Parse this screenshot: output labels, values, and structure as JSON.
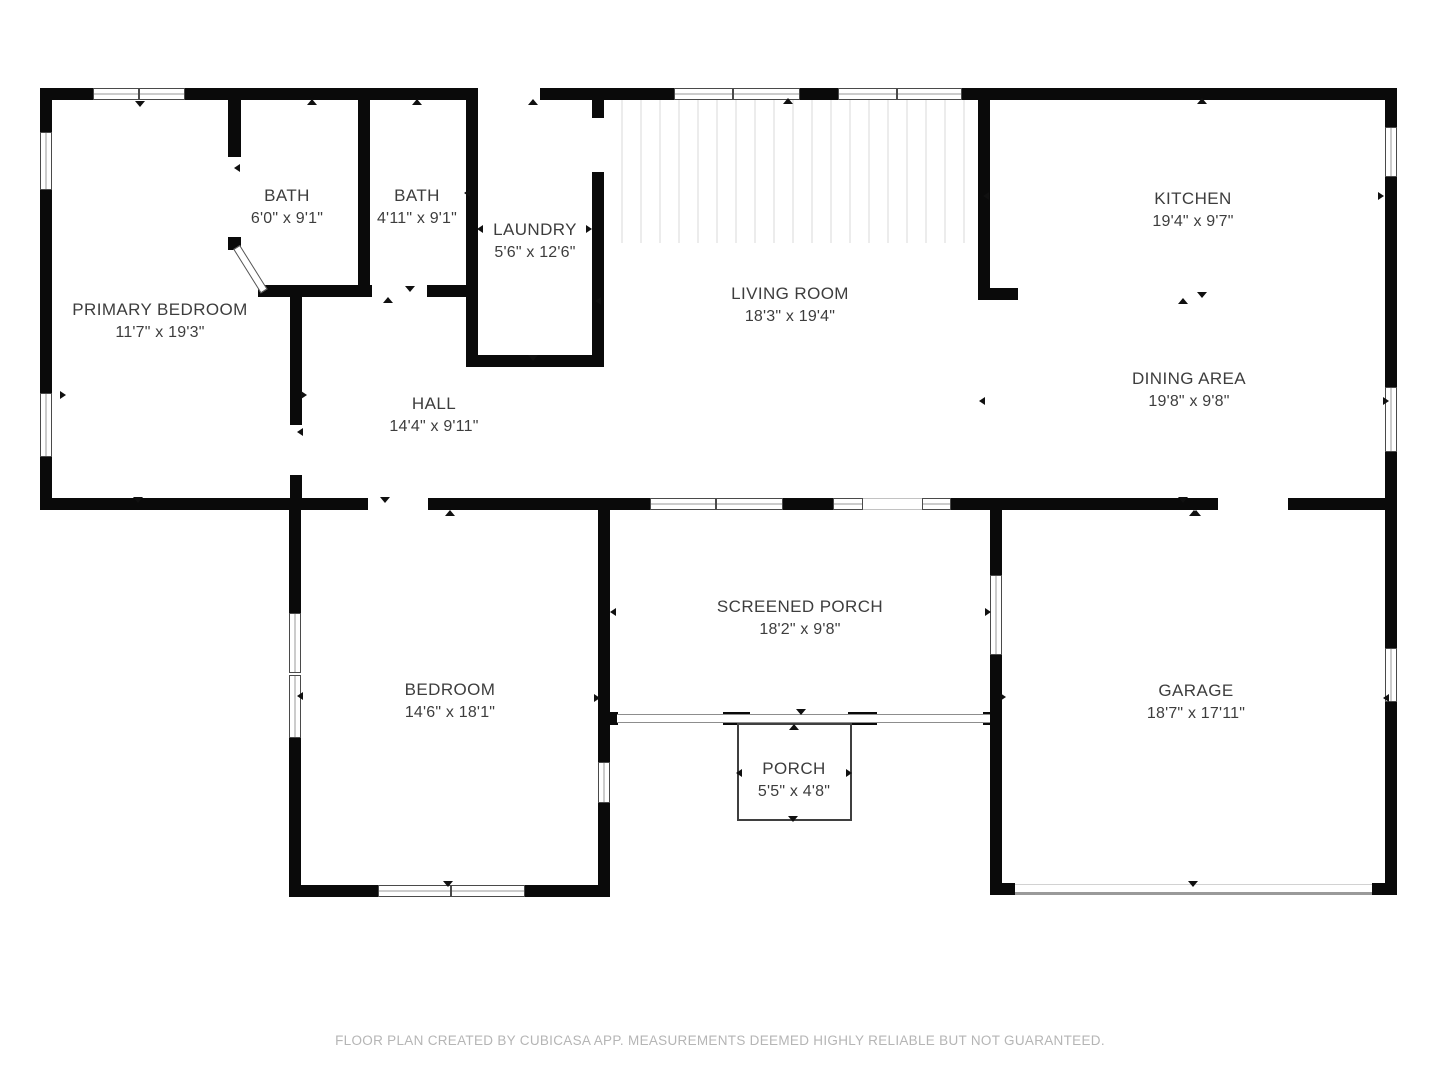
{
  "page": {
    "width": 1440,
    "height": 1080,
    "background": "#ffffff"
  },
  "palette": {
    "wall": "#0a0a0a",
    "label_text": "#3d3d3d",
    "footer_text": "#b5b5b5",
    "window_frame": "#4a4a4a",
    "screen_line": "#8d8d8d"
  },
  "footer": {
    "text": "FLOOR PLAN CREATED BY CUBICASA APP. MEASUREMENTS DEEMED HIGHLY RELIABLE BUT NOT GUARANTEED."
  },
  "rooms": [
    {
      "id": "primary-bedroom",
      "name": "PRIMARY BEDROOM",
      "dims": "11'7\" x 19'3\"",
      "cx": 160,
      "cy": 321
    },
    {
      "id": "bath-1",
      "name": "BATH",
      "dims": "6'0\" x 9'1\"",
      "cx": 287,
      "cy": 207
    },
    {
      "id": "bath-2",
      "name": "BATH",
      "dims": "4'11\" x 9'1\"",
      "cx": 417,
      "cy": 207
    },
    {
      "id": "laundry",
      "name": "LAUNDRY",
      "dims": "5'6\" x 12'6\"",
      "cx": 535,
      "cy": 241
    },
    {
      "id": "living-room",
      "name": "LIVING ROOM",
      "dims": "18'3\" x 19'4\"",
      "cx": 790,
      "cy": 305
    },
    {
      "id": "kitchen",
      "name": "KITCHEN",
      "dims": "19'4\" x 9'7\"",
      "cx": 1193,
      "cy": 210
    },
    {
      "id": "dining-area",
      "name": "DINING AREA",
      "dims": "19'8\" x 9'8\"",
      "cx": 1189,
      "cy": 390
    },
    {
      "id": "hall",
      "name": "HALL",
      "dims": "14'4\" x 9'11\"",
      "cx": 434,
      "cy": 415
    },
    {
      "id": "bedroom",
      "name": "BEDROOM",
      "dims": "14'6\" x 18'1\"",
      "cx": 450,
      "cy": 701
    },
    {
      "id": "screened-porch",
      "name": "SCREENED PORCH",
      "dims": "18'2\" x 9'8\"",
      "cx": 800,
      "cy": 618
    },
    {
      "id": "porch",
      "name": "PORCH",
      "dims": "5'5\" x 4'8\"",
      "cx": 794,
      "cy": 780
    },
    {
      "id": "garage",
      "name": "GARAGE",
      "dims": "18'7\" x 17'11\"",
      "cx": 1196,
      "cy": 702
    }
  ],
  "structure": {
    "walls": [
      [
        40,
        88,
        53,
        12
      ],
      [
        185,
        88,
        293,
        12
      ],
      [
        540,
        88,
        134,
        12
      ],
      [
        800,
        88,
        38,
        12
      ],
      [
        962,
        88,
        435,
        12
      ],
      [
        40,
        100,
        12,
        32
      ],
      [
        40,
        190,
        12,
        203
      ],
      [
        40,
        457,
        12,
        53
      ],
      [
        1385,
        100,
        12,
        27
      ],
      [
        1385,
        177,
        12,
        210
      ],
      [
        1385,
        452,
        12,
        196
      ],
      [
        1385,
        702,
        12,
        193
      ],
      [
        40,
        498,
        328,
        12
      ],
      [
        428,
        498,
        222,
        12
      ],
      [
        783,
        498,
        50,
        12
      ],
      [
        951,
        498,
        267,
        12
      ],
      [
        1288,
        498,
        109,
        12
      ],
      [
        228,
        100,
        13,
        57
      ],
      [
        228,
        237,
        13,
        13
      ],
      [
        358,
        100,
        12,
        185
      ],
      [
        258,
        285,
        114,
        12
      ],
      [
        427,
        285,
        51,
        12
      ],
      [
        466,
        100,
        12,
        255
      ],
      [
        466,
        355,
        138,
        12
      ],
      [
        592,
        100,
        12,
        18
      ],
      [
        592,
        172,
        12,
        183
      ],
      [
        290,
        297,
        12,
        128
      ],
      [
        290,
        475,
        12,
        23
      ],
      [
        978,
        100,
        12,
        200
      ],
      [
        978,
        288,
        40,
        12
      ],
      [
        289,
        510,
        12,
        103
      ],
      [
        289,
        738,
        12,
        159
      ],
      [
        289,
        885,
        89,
        12
      ],
      [
        525,
        885,
        85,
        12
      ],
      [
        598,
        510,
        12,
        252
      ],
      [
        598,
        803,
        12,
        94
      ],
      [
        610,
        712,
        8,
        13
      ],
      [
        723,
        712,
        27,
        13
      ],
      [
        848,
        712,
        29,
        13
      ],
      [
        983,
        712,
        7,
        13
      ],
      [
        990,
        510,
        12,
        65
      ],
      [
        990,
        655,
        12,
        240
      ],
      [
        990,
        883,
        25,
        12
      ],
      [
        1372,
        883,
        25,
        12
      ]
    ],
    "windows": [
      [
        93,
        88,
        46,
        12,
        "h"
      ],
      [
        139,
        88,
        46,
        12,
        "h"
      ],
      [
        674,
        88,
        59,
        12,
        "h"
      ],
      [
        733,
        88,
        67,
        12,
        "h"
      ],
      [
        838,
        88,
        59,
        12,
        "h"
      ],
      [
        897,
        88,
        65,
        12,
        "h"
      ],
      [
        650,
        498,
        66,
        12,
        "h"
      ],
      [
        716,
        498,
        67,
        12,
        "h"
      ],
      [
        833,
        498,
        30,
        12,
        "h"
      ],
      [
        922,
        498,
        29,
        12,
        "h"
      ],
      [
        378,
        885,
        73,
        12,
        "h"
      ],
      [
        451,
        885,
        74,
        12,
        "h"
      ],
      [
        40,
        132,
        12,
        58,
        "v"
      ],
      [
        40,
        393,
        12,
        64,
        "v"
      ],
      [
        1385,
        127,
        12,
        50,
        "v"
      ],
      [
        1385,
        387,
        12,
        65,
        "v"
      ],
      [
        1385,
        648,
        12,
        54,
        "v"
      ],
      [
        289,
        613,
        12,
        60,
        "v"
      ],
      [
        289,
        675,
        12,
        63,
        "v"
      ],
      [
        598,
        762,
        12,
        41,
        "v"
      ],
      [
        990,
        575,
        12,
        80,
        "v"
      ]
    ],
    "lites": [
      [
        863,
        498,
        59,
        12
      ]
    ],
    "screen_band": [
      617,
      714,
      373,
      9
    ],
    "porch_outline": [
      737,
      723,
      115,
      98
    ],
    "garage_door_lines": {
      "faint": [
        1015,
        884,
        357,
        1
      ],
      "main": [
        1015,
        892,
        357,
        3
      ]
    },
    "stripes": [
      604,
      100,
      374,
      143
    ],
    "door_diagonal": {
      "x": 240,
      "y": 245,
      "len": 52,
      "thickness": 8,
      "angle_deg": 58
    },
    "markers": [
      [
        140,
        104,
        "down"
      ],
      [
        312,
        102,
        "up"
      ],
      [
        417,
        102,
        "up"
      ],
      [
        237,
        168,
        "left"
      ],
      [
        410,
        289,
        "down"
      ],
      [
        388,
        300,
        "up"
      ],
      [
        467,
        193,
        "left"
      ],
      [
        480,
        229,
        "left"
      ],
      [
        589,
        229,
        "right"
      ],
      [
        533,
        102,
        "up"
      ],
      [
        533,
        358,
        "down"
      ],
      [
        598,
        301,
        "left"
      ],
      [
        788,
        101,
        "up"
      ],
      [
        1202,
        101,
        "up"
      ],
      [
        986,
        196,
        "left"
      ],
      [
        1381,
        196,
        "right"
      ],
      [
        1183,
        301,
        "up"
      ],
      [
        1202,
        295,
        "down"
      ],
      [
        982,
        401,
        "left"
      ],
      [
        1386,
        401,
        "right"
      ],
      [
        1183,
        500,
        "down"
      ],
      [
        1196,
        513,
        "up"
      ],
      [
        385,
        500,
        "down"
      ],
      [
        450,
        513,
        "up"
      ],
      [
        138,
        500,
        "down"
      ],
      [
        63,
        395,
        "right"
      ],
      [
        304,
        395,
        "right"
      ],
      [
        300,
        432,
        "left"
      ],
      [
        300,
        696,
        "left"
      ],
      [
        597,
        698,
        "right"
      ],
      [
        613,
        612,
        "left"
      ],
      [
        988,
        612,
        "right"
      ],
      [
        801,
        712,
        "down"
      ],
      [
        794,
        727,
        "up"
      ],
      [
        739,
        773,
        "left"
      ],
      [
        849,
        773,
        "right"
      ],
      [
        793,
        819,
        "down"
      ],
      [
        1003,
        697,
        "right"
      ],
      [
        1386,
        698,
        "left"
      ],
      [
        1193,
        884,
        "down"
      ],
      [
        1194,
        513,
        "up"
      ],
      [
        448,
        884,
        "down"
      ]
    ]
  }
}
